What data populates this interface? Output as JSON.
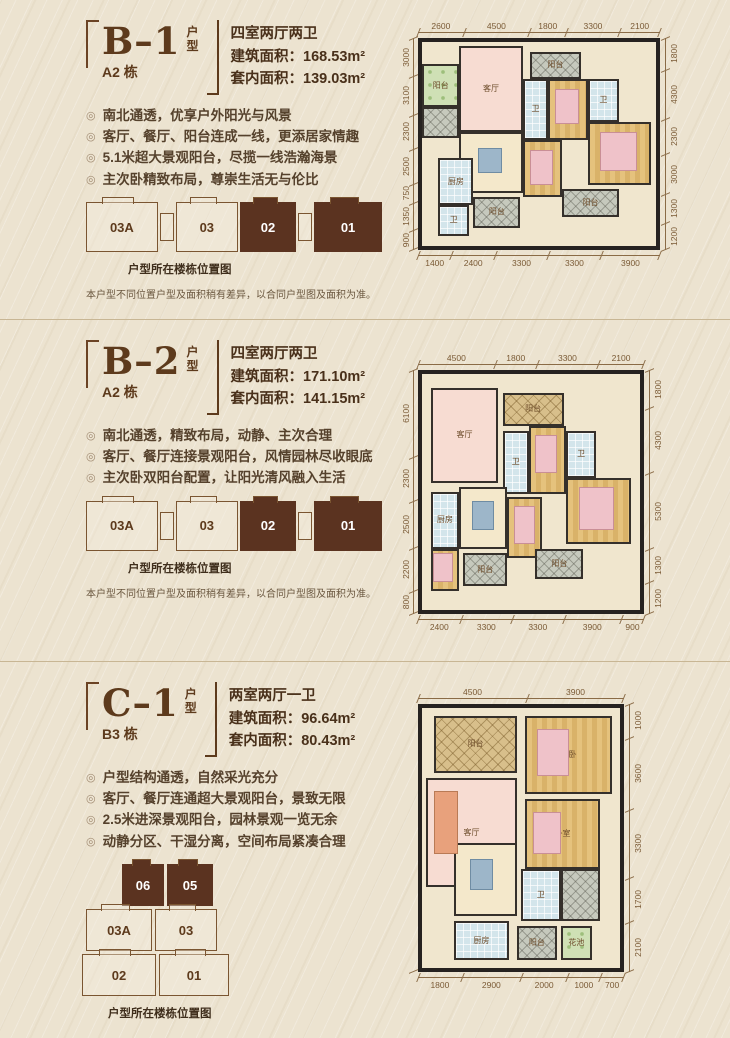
{
  "colors": {
    "background": "#ece3d0",
    "title_brown": "#5d3a1c",
    "active_unit_fill": "#5b3320",
    "dimension_line": "#8a6b46",
    "living_pink": "#f7dcd2",
    "bedroom_wood": "#dcb56e",
    "tile_blue": "#d3e5eb",
    "balcony_gray": "#c6c9bd",
    "garden_green": "#cfe0b5"
  },
  "sections": [
    {
      "name": "B–1",
      "type_chars": {
        "top": "户",
        "bottom": "型"
      },
      "building": "A2 栋",
      "spec": "四室两厅两卫",
      "area_rows": [
        {
          "label": "建筑面积：",
          "value": "168.53m²"
        },
        {
          "label": "套内面积：",
          "value": "139.03m²"
        }
      ],
      "features": [
        "南北通透，优享户外阳光与风景",
        "客厅、餐厅、阳台连成一线，更添居家情趣",
        "5.1米超大景观阳台，尽揽一线浩瀚海景",
        "主次卧精致布局，尊崇生活无与伦比"
      ],
      "units": [
        {
          "label": "03A",
          "active": false
        },
        {
          "label": "03",
          "active": false
        },
        {
          "label": "02",
          "active": true
        },
        {
          "label": "01",
          "active": true
        }
      ],
      "caption": "户型所在楼栋位置图",
      "note": "本户型不同位置户型及面积稍有差异，以合同户型图及面积为准。",
      "dims": {
        "top": [
          "2600",
          "4500",
          "1800",
          "3300",
          "2100"
        ],
        "bottom": [
          "1400",
          "2400",
          "3300",
          "3300",
          "3900"
        ],
        "left": [
          "3000",
          "3100",
          "2300",
          "2500",
          "750",
          "1350",
          "900"
        ],
        "right": [
          "1800",
          "4300",
          "2300",
          "3000",
          "1300",
          "1200"
        ]
      },
      "rooms": [
        {
          "label": "阳台",
          "cls": "plants",
          "style": "left:0%;top:11%;width:16%;height:21%"
        },
        {
          "label": "",
          "cls": "hatch",
          "style": "left:0%;top:32%;width:16%;height:15%"
        },
        {
          "label": "客厅",
          "cls": "pink",
          "style": "left:16%;top:2%;width:27%;height:42%"
        },
        {
          "label": "阳台",
          "cls": "hatch",
          "style": "left:46%;top:5%;width:22%;height:13%"
        },
        {
          "label": "卫",
          "cls": "tile",
          "style": "left:43%;top:18%;width:11%;height:30%"
        },
        {
          "label": "卧室",
          "cls": "wood",
          "style": "left:54%;top:18%;width:17%;height:30%"
        },
        {
          "label": "卫",
          "cls": "tile",
          "style": "left:71%;top:18%;width:13%;height:21%"
        },
        {
          "label": "主卧",
          "cls": "wood",
          "style": "left:71%;top:39%;width:27%;height:31%"
        },
        {
          "label": "餐厅",
          "cls": "cream",
          "style": "left:16%;top:44%;width:27%;height:30%"
        },
        {
          "label": "厨房",
          "cls": "tile",
          "style": "left:7%;top:57%;width:15%;height:23%"
        },
        {
          "label": "卫",
          "cls": "tile",
          "style": "left:7%;top:80%;width:13%;height:15%"
        },
        {
          "label": "卧室",
          "cls": "wood",
          "style": "left:43%;top:48%;width:17%;height:28%"
        },
        {
          "label": "阳台",
          "cls": "hatch",
          "style": "left:22%;top:76%;width:20%;height:15%"
        },
        {
          "label": "阳台",
          "cls": "hatch",
          "style": "left:60%;top:72%;width:24%;height:14%"
        },
        {
          "label": "",
          "cls": "bed",
          "style": "left:57%;top:23%;width:10%;height:17%"
        },
        {
          "label": "",
          "cls": "bed",
          "style": "left:46%;top:53%;width:10%;height:17%"
        },
        {
          "label": "",
          "cls": "bed",
          "style": "left:76%;top:44%;width:16%;height:19%"
        },
        {
          "label": "",
          "cls": "tableb",
          "style": "left:24%;top:52%;width:10%;height:12%"
        }
      ]
    },
    {
      "name": "B–2",
      "type_chars": {
        "top": "户",
        "bottom": "型"
      },
      "building": "A2 栋",
      "spec": "四室两厅两卫",
      "area_rows": [
        {
          "label": "建筑面积：",
          "value": "171.10m²"
        },
        {
          "label": "套内面积：",
          "value": "141.15m²"
        }
      ],
      "features": [
        "南北通透，精致布局，动静、主次合理",
        "客厅、餐厅连接景观阳台，风情园林尽收眼底",
        "主次卧双阳台配置，让阳光清风融入生活"
      ],
      "units": [
        {
          "label": "03A",
          "active": false
        },
        {
          "label": "03",
          "active": false
        },
        {
          "label": "02",
          "active": true
        },
        {
          "label": "01",
          "active": true
        }
      ],
      "caption": "户型所在楼栋位置图",
      "note": "本户型不同位置户型及面积稍有差异，以合同户型图及面积为准。",
      "dims": {
        "top": [
          "4500",
          "1800",
          "3300",
          "2100"
        ],
        "bottom": [
          "2400",
          "3300",
          "3300",
          "3900",
          "900"
        ],
        "left": [
          "6100",
          "2300",
          "2500",
          "2200",
          "800"
        ],
        "right": [
          "1800",
          "4300",
          "5300",
          "1300",
          "1200"
        ]
      },
      "rooms": [
        {
          "label": "客厅",
          "cls": "pink",
          "style": "left:4%;top:6%;width:31%;height:40%"
        },
        {
          "label": "阳台",
          "cls": "woodhatch",
          "style": "left:37%;top:8%;width:28%;height:14%"
        },
        {
          "label": "卫",
          "cls": "tile",
          "style": "left:37%;top:24%;width:12%;height:27%"
        },
        {
          "label": "卧室",
          "cls": "wood",
          "style": "left:49%;top:22%;width:17%;height:29%"
        },
        {
          "label": "卫",
          "cls": "tile",
          "style": "left:66%;top:24%;width:14%;height:20%"
        },
        {
          "label": "主卧",
          "cls": "wood",
          "style": "left:66%;top:44%;width:30%;height:28%"
        },
        {
          "label": "餐厅",
          "cls": "cream",
          "style": "left:17%;top:48%;width:22%;height:26%"
        },
        {
          "label": "厨房",
          "cls": "tile",
          "style": "left:4%;top:50%;width:13%;height:24%"
        },
        {
          "label": "卧室",
          "cls": "wood",
          "style": "left:39%;top:52%;width:16%;height:26%"
        },
        {
          "label": "卧室",
          "cls": "wood",
          "style": "left:4%;top:74%;width:13%;height:18%"
        },
        {
          "label": "阳台",
          "cls": "hatch",
          "style": "left:19%;top:76%;width:20%;height:14%"
        },
        {
          "label": "阳台",
          "cls": "hatch",
          "style": "left:52%;top:74%;width:22%;height:13%"
        },
        {
          "label": "",
          "cls": "bed",
          "style": "left:52%;top:26%;width:10%;height:16%"
        },
        {
          "label": "",
          "cls": "bed",
          "style": "left:72%;top:48%;width:16%;height:18%"
        },
        {
          "label": "",
          "cls": "bed",
          "style": "left:42%;top:56%;width:10%;height:16%"
        },
        {
          "label": "",
          "cls": "bed",
          "style": "left:5%;top:76%;width:9%;height:12%"
        },
        {
          "label": "",
          "cls": "tableb",
          "style": "left:23%;top:54%;width:10%;height:12%"
        }
      ]
    },
    {
      "name": "C–1",
      "type_chars": {
        "top": "户",
        "bottom": "型"
      },
      "building": "B3 栋",
      "spec": "两室两厅一卫",
      "area_rows": [
        {
          "label": "建筑面积：",
          "value": "96.64m²"
        },
        {
          "label": "套内面积：",
          "value": "80.43m²"
        }
      ],
      "features": [
        "户型结构通透，自然采光充分",
        "客厅、餐厅连通超大景观阳台，景致无限",
        "2.5米进深景观阳台，园林景观一览无余",
        "动静分区、干湿分离，空间布局紧凑合理"
      ],
      "units": [
        {
          "label": "06",
          "active": true
        },
        {
          "label": "05",
          "active": true
        },
        {
          "label": "03A",
          "active": false
        },
        {
          "label": "03",
          "active": false
        },
        {
          "label": "02",
          "active": false
        },
        {
          "label": "01",
          "active": false
        }
      ],
      "caption": "户型所在楼栋位置图",
      "note": "",
      "dims": {
        "top": [
          "4500",
          "3900"
        ],
        "bottom": [
          "1800",
          "2900",
          "2000",
          "1000",
          "700"
        ],
        "left": [],
        "right": [
          "1000",
          "3600",
          "3300",
          "1700",
          "2100"
        ]
      },
      "rooms": [
        {
          "label": "阳台",
          "cls": "woodhatch",
          "style": "left:6%;top:3%;width:42%;height:22%"
        },
        {
          "label": "主卧",
          "cls": "wood",
          "style": "left:52%;top:3%;width:44%;height:30%"
        },
        {
          "label": "客厅",
          "cls": "pink",
          "style": "left:2%;top:27%;width:46%;height:42%"
        },
        {
          "label": "卧室",
          "cls": "wood",
          "style": "left:52%;top:35%;width:38%;height:27%"
        },
        {
          "label": "餐厅",
          "cls": "cream",
          "style": "left:16%;top:52%;width:32%;height:28%"
        },
        {
          "label": "卫",
          "cls": "tile",
          "style": "left:50%;top:62%;width:20%;height:20%"
        },
        {
          "label": "",
          "cls": "hatch",
          "style": "left:70%;top:62%;width:20%;height:20%"
        },
        {
          "label": "厨房",
          "cls": "tile",
          "style": "left:16%;top:82%;width:28%;height:15%"
        },
        {
          "label": "阳台",
          "cls": "hatch",
          "style": "left:48%;top:84%;width:20%;height:13%"
        },
        {
          "label": "花池",
          "cls": "plants",
          "style": "left:70%;top:84%;width:16%;height:13%"
        },
        {
          "label": "",
          "cls": "bed",
          "style": "left:58%;top:8%;width:16%;height:18%"
        },
        {
          "label": "",
          "cls": "bed",
          "style": "left:56%;top:40%;width:14%;height:16%"
        },
        {
          "label": "",
          "cls": "sofa",
          "style": "left:6%;top:32%;width:12%;height:24%"
        },
        {
          "label": "",
          "cls": "tableb",
          "style": "left:24%;top:58%;width:12%;height:12%"
        }
      ]
    }
  ]
}
